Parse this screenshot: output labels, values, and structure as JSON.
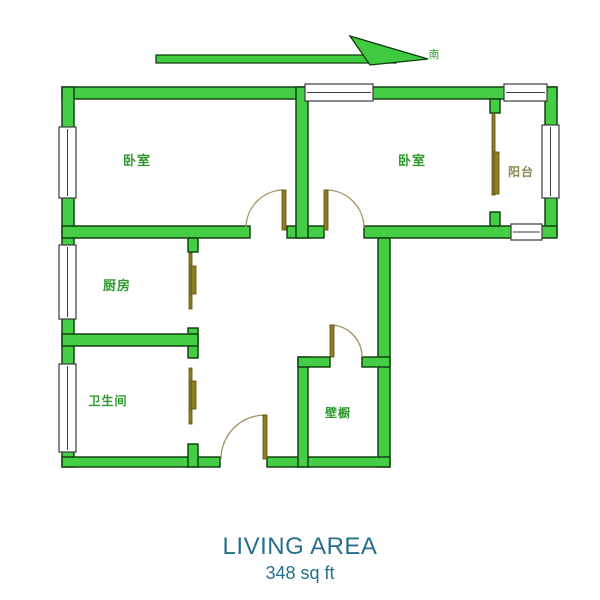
{
  "compass": {
    "direction_label": "南",
    "label_color": "#2f9b2f",
    "arrow_fill": "#3fca3f",
    "arrow_stroke": "#0c3a0c",
    "label_pos": {
      "x": 434,
      "y": 58
    },
    "shapes": [
      {
        "points": "156,55 396,55 396,63 156,63",
        "name": "compass-arrow-tail"
      },
      {
        "points": "350,36 428,59 370,65",
        "name": "compass-arrow-head"
      }
    ]
  },
  "plan": {
    "wall_fill": "#45cd45",
    "wall_stroke": "#0c3a0c",
    "arc_color": "#a29060",
    "leaf_fill": "#8f7f22",
    "leaf_stroke": "#564b10",
    "window_stroke": "#3b3b3b",
    "walls": [
      {
        "x": 62,
        "y": 87,
        "w": 495,
        "h": 12,
        "name": "wall-top"
      },
      {
        "x": 62,
        "y": 87,
        "w": 12,
        "h": 380,
        "name": "wall-left"
      },
      {
        "x": 545,
        "y": 87,
        "w": 12,
        "h": 149,
        "name": "wall-right-balcony"
      },
      {
        "x": 62,
        "y": 226,
        "w": 188,
        "h": 12,
        "name": "wall-mid-left"
      },
      {
        "x": 287,
        "y": 226,
        "w": 37,
        "h": 12,
        "name": "wall-mid-center"
      },
      {
        "x": 364,
        "y": 226,
        "w": 193,
        "h": 12,
        "name": "wall-mid-right"
      },
      {
        "x": 296,
        "y": 87,
        "w": 12,
        "h": 151,
        "name": "wall-bedroom-divider"
      },
      {
        "x": 490,
        "y": 99,
        "w": 10,
        "h": 14,
        "name": "wall-balcony-divider-top-stub"
      },
      {
        "x": 490,
        "y": 212,
        "w": 10,
        "h": 14,
        "name": "wall-balcony-divider-bottom-stub"
      },
      {
        "x": 378,
        "y": 238,
        "w": 12,
        "h": 229,
        "name": "wall-lower-right"
      },
      {
        "x": 62,
        "y": 457,
        "w": 158,
        "h": 10,
        "name": "wall-bottom-left"
      },
      {
        "x": 267,
        "y": 457,
        "w": 123,
        "h": 10,
        "name": "wall-bottom-right"
      },
      {
        "x": 188,
        "y": 238,
        "w": 10,
        "h": 14,
        "name": "wall-kitchen-right-stub"
      },
      {
        "x": 188,
        "y": 328,
        "w": 10,
        "h": 30,
        "name": "wall-kitchen-bath-junction"
      },
      {
        "x": 62,
        "y": 334,
        "w": 136,
        "h": 12,
        "name": "wall-kitchen-bath-divider"
      },
      {
        "x": 188,
        "y": 444,
        "w": 10,
        "h": 23,
        "name": "wall-bathroom-right-bottom"
      },
      {
        "x": 298,
        "y": 357,
        "w": 10,
        "h": 110,
        "name": "wall-closet-left"
      },
      {
        "x": 298,
        "y": 357,
        "w": 32,
        "h": 10,
        "name": "wall-closet-top-left"
      },
      {
        "x": 362,
        "y": 357,
        "w": 28,
        "h": 10,
        "name": "wall-closet-top-right"
      }
    ],
    "windows": [
      {
        "x": 59,
        "y": 127,
        "w": 17,
        "h": 71,
        "name": "window-bedroom-left"
      },
      {
        "x": 59,
        "y": 245,
        "w": 17,
        "h": 74,
        "name": "window-kitchen"
      },
      {
        "x": 59,
        "y": 364,
        "w": 17,
        "h": 88,
        "name": "window-bathroom"
      },
      {
        "x": 305,
        "y": 84,
        "w": 68,
        "h": 17,
        "name": "window-bedroom-right-top"
      },
      {
        "x": 504,
        "y": 84,
        "w": 43,
        "h": 17,
        "name": "window-balcony-top"
      },
      {
        "x": 542,
        "y": 125,
        "w": 17,
        "h": 73,
        "name": "window-balcony-right"
      },
      {
        "x": 511,
        "y": 224,
        "w": 31,
        "h": 16,
        "name": "window-balcony-bottom"
      }
    ],
    "door_leaves": [
      {
        "x": 282,
        "y": 190,
        "w": 4,
        "h": 40,
        "name": "door-leaf-bedroom-left"
      },
      {
        "x": 324,
        "y": 190,
        "w": 4,
        "h": 40,
        "name": "door-leaf-bedroom-right"
      },
      {
        "x": 330,
        "y": 325,
        "w": 4,
        "h": 32,
        "name": "door-leaf-closet"
      },
      {
        "x": 263,
        "y": 415,
        "w": 4,
        "h": 44,
        "name": "door-leaf-entry"
      },
      {
        "x": 189,
        "y": 253,
        "w": 3,
        "h": 56,
        "name": "door-leaf-kitchen"
      },
      {
        "x": 191,
        "y": 266,
        "w": 5,
        "h": 28,
        "name": "door-leaf-kitchen-handle"
      },
      {
        "x": 189,
        "y": 368,
        "w": 3,
        "h": 56,
        "name": "door-leaf-bathroom"
      },
      {
        "x": 191,
        "y": 381,
        "w": 5,
        "h": 28,
        "name": "door-leaf-bathroom-handle"
      },
      {
        "x": 492,
        "y": 113,
        "w": 3,
        "h": 82,
        "name": "door-leaf-balcony"
      },
      {
        "x": 494,
        "y": 152,
        "w": 5,
        "h": 42,
        "name": "door-leaf-balcony-handle"
      }
    ],
    "door_arcs": [
      {
        "d": "M246,228 A38,38 0 0 1 284,190",
        "name": "door-arc-bedroom-left"
      },
      {
        "d": "M326,190 A38,38 0 0 1 364,228",
        "name": "door-arc-bedroom-right"
      },
      {
        "d": "M330,325 A32,32 0 0 1 362,357",
        "name": "door-arc-closet"
      },
      {
        "d": "M221,459 A44,44 0 0 1 265,415",
        "name": "door-arc-entry"
      }
    ],
    "room_labels": [
      {
        "text": "卧室",
        "x": 137,
        "y": 165,
        "size": 13,
        "color": "#2f9b2f",
        "name": "room-label-bedroom-left"
      },
      {
        "text": "卧室",
        "x": 412,
        "y": 165,
        "size": 13,
        "color": "#2f9b2f",
        "name": "room-label-bedroom-right"
      },
      {
        "text": "阳台",
        "x": 521,
        "y": 176,
        "size": 12,
        "color": "#8b8b55",
        "name": "room-label-balcony"
      },
      {
        "text": "厨房",
        "x": 117,
        "y": 290,
        "size": 13,
        "color": "#2f9b2f",
        "name": "room-label-kitchen"
      },
      {
        "text": "卫生间",
        "x": 108,
        "y": 405,
        "size": 12,
        "color": "#2f9b2f",
        "name": "room-label-bathroom"
      },
      {
        "text": "壁橱",
        "x": 338,
        "y": 417,
        "size": 12,
        "color": "#2f9b2f",
        "name": "room-label-closet"
      }
    ]
  },
  "footer": {
    "area_title": "LIVING AREA",
    "area_value": "348 sq ft",
    "text_color": "#26708c"
  }
}
